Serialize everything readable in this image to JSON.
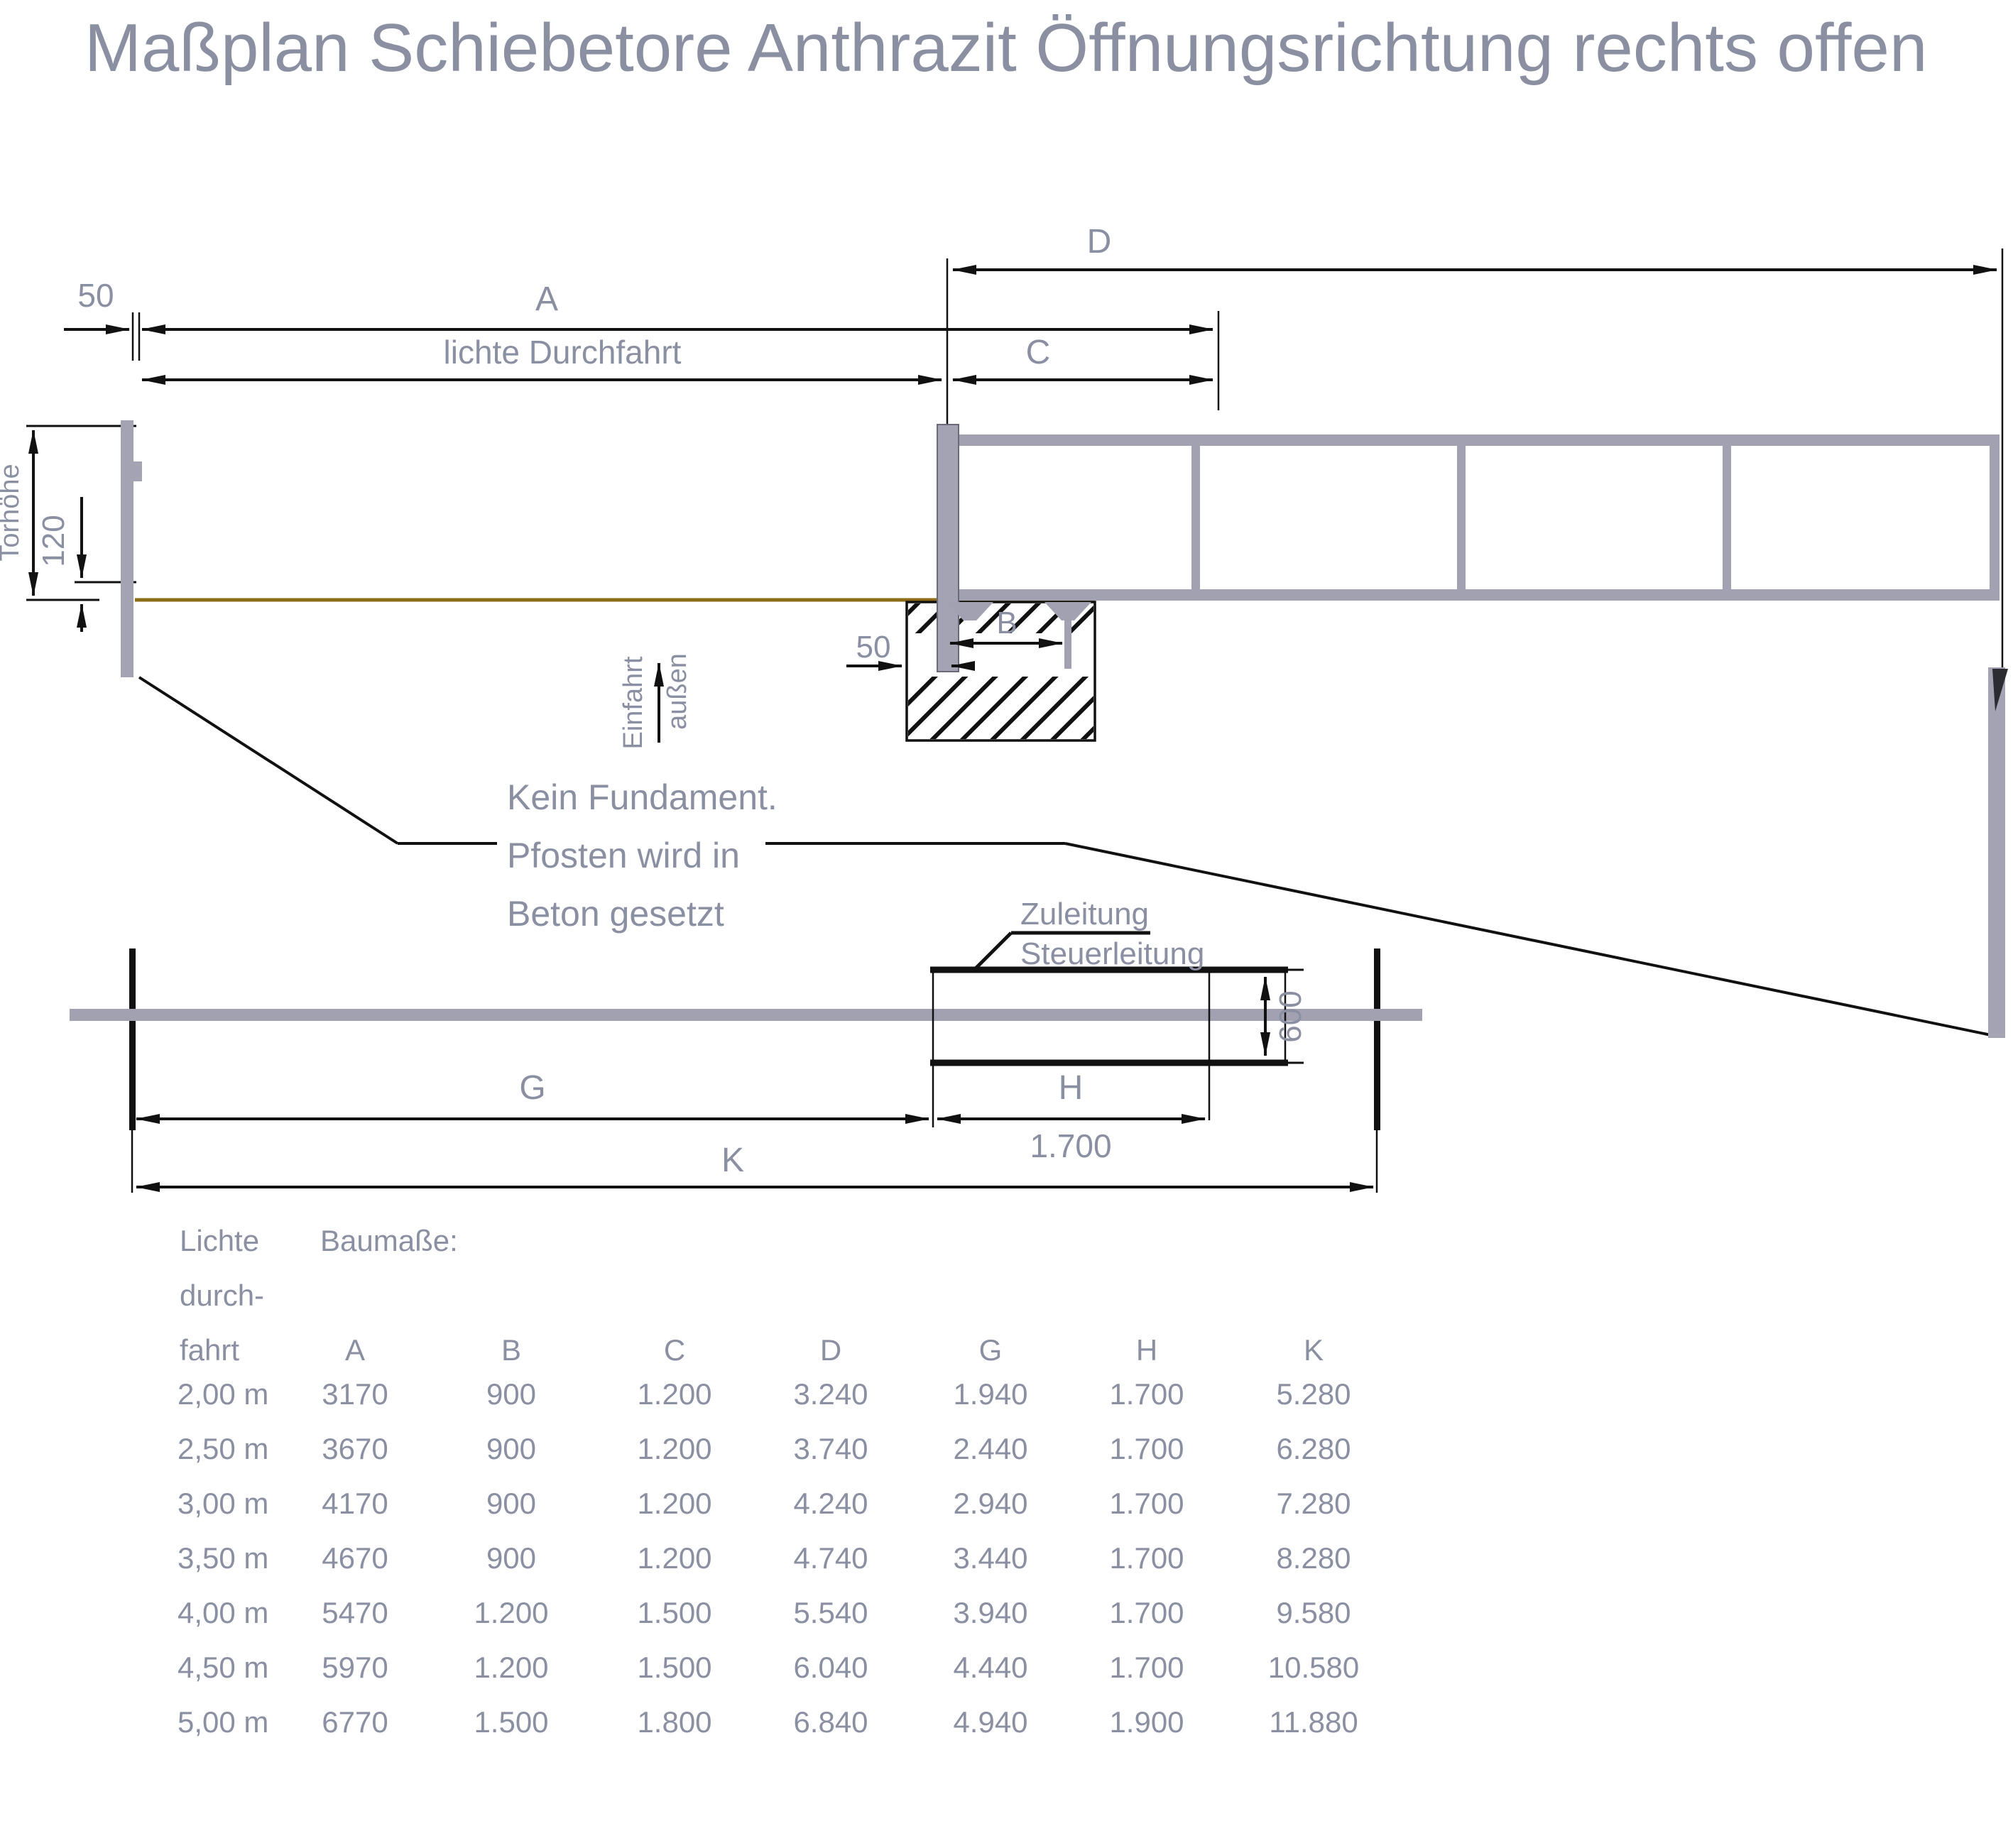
{
  "title": "Maßplan Schiebetore Anthrazit Öffnungsrichtung rechts offen",
  "colors": {
    "label_gray": "#8a8fa2",
    "line_black": "#111111",
    "gate_gray": "#a1a1b2",
    "post_gray": "#a3a3b3",
    "ground_brown": "#8e6c15",
    "background": "#ffffff"
  },
  "side_view": {
    "dim_50_top": "50",
    "dim_A": "A",
    "dim_clear_passage": "lichte Durchfahrt",
    "dim_C": "C",
    "dim_D": "D",
    "dim_B": "B",
    "dim_50_bottom": "50",
    "dim_gate_height": "Torhöhe",
    "dim_120": "120",
    "entry_label": "Einfahrt",
    "outside_label": "außen",
    "note_line1": "Kein Fundament.",
    "note_line2": "Pfosten wird in",
    "note_line3": "Beton gesetzt"
  },
  "plan_view": {
    "supply_line": "Zuleitung",
    "control_line": "Steuerleitung",
    "dim_600": "600",
    "dim_G": "G",
    "dim_H": "H",
    "dim_1700": "1.700",
    "dim_K": "K"
  },
  "table": {
    "row_header_line1": "Lichte",
    "row_header_line2": "durch-",
    "row_header_line3": "fahrt",
    "title": "Baumaße:",
    "columns": [
      "A",
      "B",
      "C",
      "D",
      "G",
      "H",
      "K"
    ],
    "rows": [
      {
        "clear": "2,00 m",
        "cells": [
          "3170",
          "900",
          "1.200",
          "3.240",
          "1.940",
          "1.700",
          "5.280"
        ]
      },
      {
        "clear": "2,50 m",
        "cells": [
          "3670",
          "900",
          "1.200",
          "3.740",
          "2.440",
          "1.700",
          "6.280"
        ]
      },
      {
        "clear": "3,00 m",
        "cells": [
          "4170",
          "900",
          "1.200",
          "4.240",
          "2.940",
          "1.700",
          "7.280"
        ]
      },
      {
        "clear": "3,50 m",
        "cells": [
          "4670",
          "900",
          "1.200",
          "4.740",
          "3.440",
          "1.700",
          "8.280"
        ]
      },
      {
        "clear": "4,00 m",
        "cells": [
          "5470",
          "1.200",
          "1.500",
          "5.540",
          "3.940",
          "1.700",
          "9.580"
        ]
      },
      {
        "clear": "4,50 m",
        "cells": [
          "5970",
          "1.200",
          "1.500",
          "6.040",
          "4.440",
          "1.700",
          "10.580"
        ]
      },
      {
        "clear": "5,00 m",
        "cells": [
          "6770",
          "1.500",
          "1.800",
          "6.840",
          "4.940",
          "1.900",
          "11.880"
        ]
      }
    ]
  }
}
